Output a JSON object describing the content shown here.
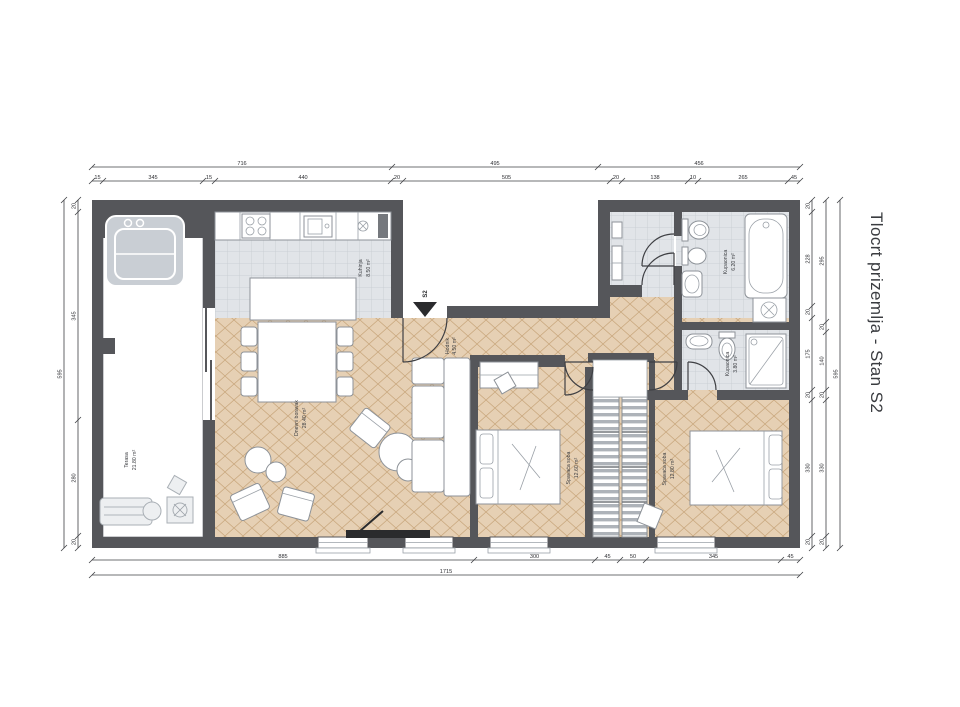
{
  "title": "Tlocrt prizemlja - Stan S2",
  "entrance": {
    "label": "S2"
  },
  "rooms": {
    "terrace": {
      "name": "Terasa",
      "area": "21.80 m²"
    },
    "kitchen": {
      "name": "Kuhinja",
      "area": "8.50 m²"
    },
    "living": {
      "name": "Dnevni boravak",
      "area": "28.40 m²"
    },
    "hall": {
      "name": "Hodnik",
      "area": "4.50 m²"
    },
    "bedroom1": {
      "name": "Spavaća soba",
      "area": "12.60 m²"
    },
    "bedroom2": {
      "name": "Spavaća soba",
      "area": "12.80 m²"
    },
    "bathroom1": {
      "name": "Kupaonica",
      "area": "6.20 m²"
    },
    "bathroom2": {
      "name": "Kupaonica",
      "area": "3.80 m²"
    }
  },
  "colors": {
    "wall": "#55565a",
    "parquet": "#e6d0b4",
    "parquet_line": "#c9a87e",
    "tile": "#dadde1",
    "tile_line": "#bfc4ca",
    "dimension": "#3f4044",
    "title_text": "#3a3c40"
  },
  "dimensions": {
    "unit": "cm",
    "chains": [
      {
        "id": "top-outer",
        "dir": "h",
        "pos": 167,
        "ticks": [
          92,
          392,
          598,
          800
        ],
        "labels": [
          "716",
          "495",
          "456"
        ]
      },
      {
        "id": "top-inner",
        "dir": "h",
        "pos": 181,
        "ticks": [
          92,
          103,
          203,
          215,
          391,
          403,
          610,
          622,
          688,
          698,
          788,
          800
        ],
        "labels": [
          "15",
          "345",
          "15",
          "440",
          "20",
          "505",
          "20",
          "138",
          "10",
          "265",
          "45"
        ]
      },
      {
        "id": "bottom-inner",
        "dir": "h",
        "pos": 560,
        "ticks": [
          92,
          474,
          595,
          620,
          646,
          781,
          800
        ],
        "labels": [
          "885",
          "300",
          "45",
          "50",
          "345",
          "45"
        ]
      },
      {
        "id": "bottom-outer",
        "dir": "h",
        "pos": 575,
        "ticks": [
          92,
          800
        ],
        "labels": [
          "1715"
        ]
      },
      {
        "id": "left-inner",
        "dir": "v",
        "pos": 78,
        "ticks": [
          200,
          212,
          420,
          536,
          548
        ],
        "labels": [
          "20",
          "345",
          "280",
          "20"
        ]
      },
      {
        "id": "left-outer",
        "dir": "v",
        "pos": 64,
        "ticks": [
          200,
          548
        ],
        "labels": [
          "595"
        ]
      },
      {
        "id": "right-1",
        "dir": "v",
        "pos": 812,
        "ticks": [
          200,
          212,
          306,
          318,
          390,
          400,
          536,
          548
        ],
        "labels": [
          "20",
          "228",
          "20",
          "175",
          "20",
          "330",
          "20"
        ]
      },
      {
        "id": "right-2",
        "dir": "v",
        "pos": 826,
        "ticks": [
          200,
          322,
          332,
          390,
          400,
          536,
          548
        ],
        "labels": [
          "295",
          "20",
          "140",
          "20",
          "330",
          "20"
        ]
      },
      {
        "id": "right-3",
        "dir": "v",
        "pos": 840,
        "ticks": [
          200,
          548
        ],
        "labels": [
          "595"
        ]
      }
    ]
  }
}
